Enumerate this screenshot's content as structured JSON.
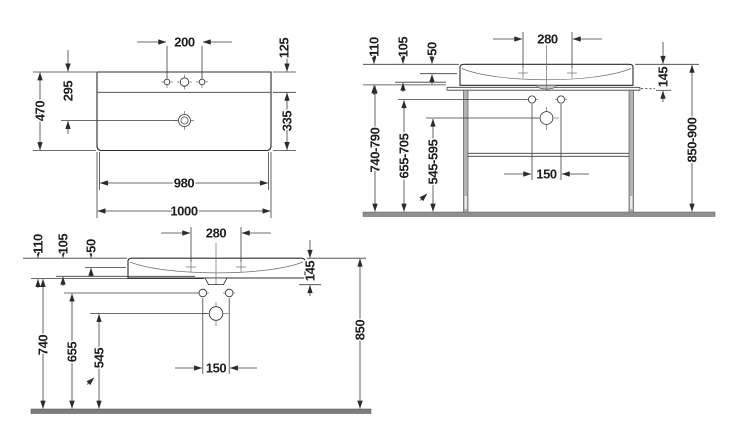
{
  "drawing": {
    "type": "washbasin-technical-drawing",
    "views": [
      "plan",
      "front-with-console",
      "front-wall-mounted"
    ]
  },
  "plan": {
    "w200": "200",
    "d125": "125",
    "d470": "470",
    "d295": "295",
    "d335": "335",
    "w980": "980",
    "w1000": "1000"
  },
  "console": {
    "d110": "110",
    "d105": "105",
    "d50": "50",
    "w280": "280",
    "d145": "145",
    "h740": "740-790",
    "h655": "655-705",
    "h545": "545-595",
    "w150": "150",
    "h850": "850-900"
  },
  "wall": {
    "d110": "110",
    "d105": "105",
    "d50": "50",
    "w280": "280",
    "d145": "145",
    "h740": "740",
    "h655": "655",
    "h545": "545",
    "w150": "150",
    "h850": "850"
  },
  "colors": {
    "line": "#3c3c3c",
    "steel": "#b3b3b3",
    "floor": "#8f8f8f",
    "text": "#1c1c1c"
  }
}
